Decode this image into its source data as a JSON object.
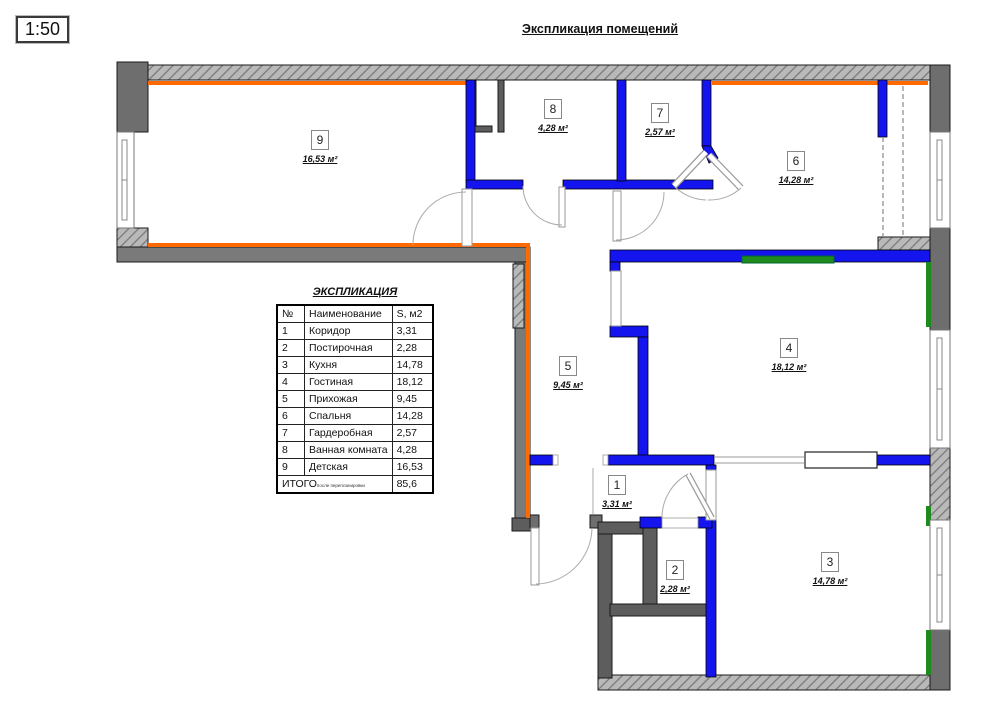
{
  "scale_badge": "1:50",
  "title": "Экспликация помещений",
  "table": {
    "title": "ЭКСПЛИКАЦИЯ",
    "col_num": "№",
    "col_name": "Наименование",
    "col_area": "S, м2",
    "rows": [
      {
        "num": "1",
        "name": "Коридор",
        "area": "3,31"
      },
      {
        "num": "2",
        "name": "Постирочная",
        "area": "2,28"
      },
      {
        "num": "3",
        "name": "Кухня",
        "area": "14,78"
      },
      {
        "num": "4",
        "name": "Гостиная",
        "area": "18,12"
      },
      {
        "num": "5",
        "name": "Прихожая",
        "area": "9,45"
      },
      {
        "num": "6",
        "name": "Спальня",
        "area": "14,28"
      },
      {
        "num": "7",
        "name": "Гардеробная",
        "area": "2,57"
      },
      {
        "num": "8",
        "name": "Ванная комната",
        "area": "4,28"
      },
      {
        "num": "9",
        "name": "Детская",
        "area": "16,53"
      }
    ],
    "total_label": "ИТОГО",
    "total_note": "после перепланировки",
    "total_value": "85,6"
  },
  "plan": {
    "rooms": {
      "r1": {
        "num": "1",
        "area": "3,31 м²"
      },
      "r2": {
        "num": "2",
        "area": "2,28 м²"
      },
      "r3": {
        "num": "3",
        "area": "14,78 м²"
      },
      "r4": {
        "num": "4",
        "area": "18,12 м²"
      },
      "r5": {
        "num": "5",
        "area": "9,45 м²"
      },
      "r6": {
        "num": "6",
        "area": "14,28 м²"
      },
      "r7": {
        "num": "7",
        "area": "2,57 м²"
      },
      "r8": {
        "num": "8",
        "area": "4,28 м²"
      },
      "r9": {
        "num": "9",
        "area": "16,53 м²"
      }
    },
    "colors": {
      "new_partition_blue": "#1414ee",
      "insulation_orange": "#ff6a00",
      "accent_green": "#1e8a1e",
      "existing_wall_gray": "#6e6e6e"
    }
  }
}
